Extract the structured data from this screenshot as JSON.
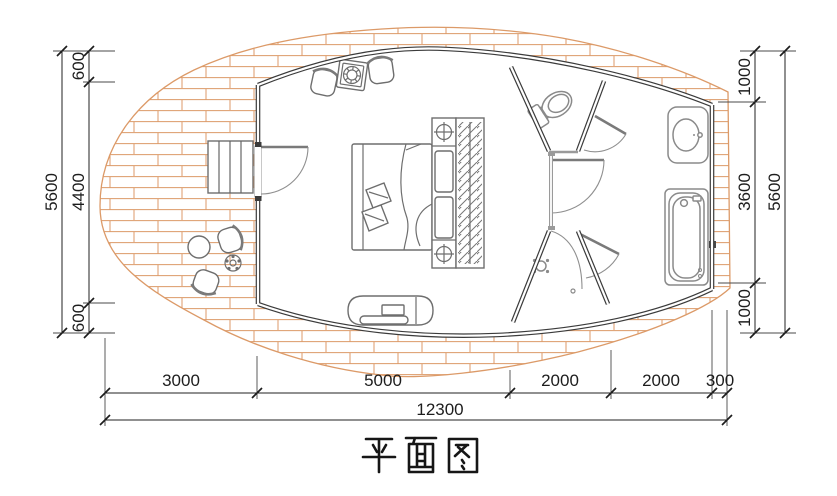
{
  "title": {
    "text": "平面图"
  },
  "dims": {
    "left": {
      "overall": "5600",
      "segments": [
        "600",
        "4400",
        "600"
      ]
    },
    "right": {
      "overall": "5600",
      "segments": [
        "1000",
        "3600",
        "1000"
      ]
    },
    "bottom": {
      "overall": "12300",
      "segments": [
        "3000",
        "5000",
        "2000",
        "2000",
        "300"
      ]
    }
  },
  "colors": {
    "deck_plank": "#DC9A68",
    "wall": "#3B3B3B",
    "fixture_line": "#8A8A8A",
    "furniture_line": "#6E6E6E",
    "dimension_line": "#222222",
    "background": "#FFFFFF"
  },
  "symbols": [
    "wood-deck",
    "stairs",
    "entry-door",
    "bed",
    "pillows",
    "nightstand-lights",
    "wardrobe",
    "lounge-chairs",
    "grill-table",
    "bench-tv",
    "outdoor-table",
    "potted-plant",
    "toilet",
    "wash-basin",
    "bathtub",
    "shower-drain",
    "door-swings"
  ]
}
